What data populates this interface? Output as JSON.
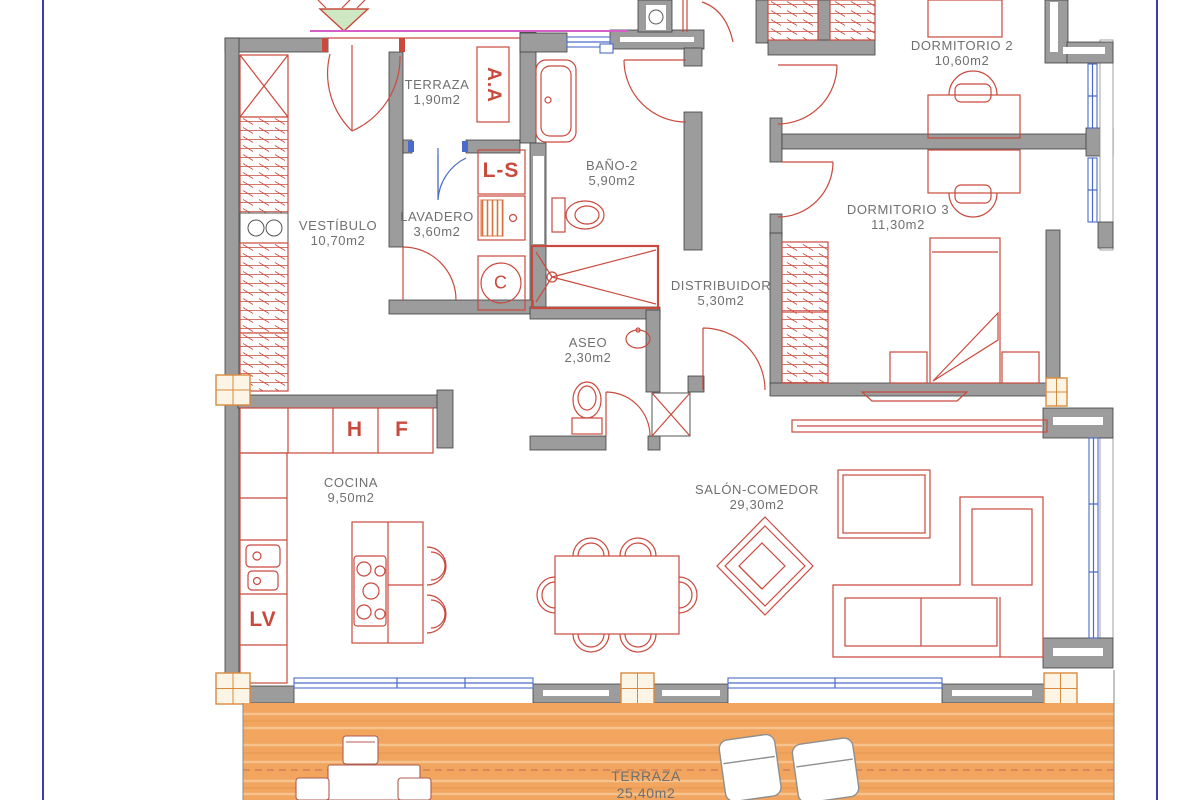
{
  "title": "Apartment floor plan drawing",
  "rooms": {
    "terraza_top": {
      "name": "TERRAZA",
      "area": "1,90m2"
    },
    "vestibulo": {
      "name": "VESTÍBULO",
      "area": "10,70m2"
    },
    "lavadero": {
      "name": "LAVADERO",
      "area": "3,60m2"
    },
    "bano2": {
      "name": "BAÑO-2",
      "area": "5,90m2"
    },
    "dormitorio2": {
      "name": "DORMITORIO 2",
      "area": "10,60m2"
    },
    "dormitorio3": {
      "name": "DORMITORIO 3",
      "area": "11,30m2"
    },
    "distribuidor": {
      "name": "DISTRIBUIDOR",
      "area": "5,30m2"
    },
    "aseo": {
      "name": "ASEO",
      "area": "2,30m2"
    },
    "cocina": {
      "name": "COCINA",
      "area": "9,50m2"
    },
    "salon": {
      "name": "SALÓN-COMEDOR",
      "area": "29,30m2"
    },
    "terraza": {
      "name": "TERRAZA",
      "area": "25,40m2"
    }
  },
  "equipment": {
    "air_conditioning": "A.A",
    "washer_dryer": "L-S",
    "boiler": "C",
    "oven": "H",
    "fridge": "F",
    "dishwasher": "LV"
  },
  "colors": {
    "wall": "#9c9c9c",
    "wallstroke": "#3f3f3f",
    "red": "#c94a3d",
    "blue": "#4a6bc9",
    "magenta": "#d45fc9",
    "orange": "#d98a3f",
    "terrace": "#f1a55e",
    "terracelight": "#f6c28e",
    "label": "#707070",
    "frame": "#3d3dab",
    "trianglefill": "#cfe8c4"
  }
}
